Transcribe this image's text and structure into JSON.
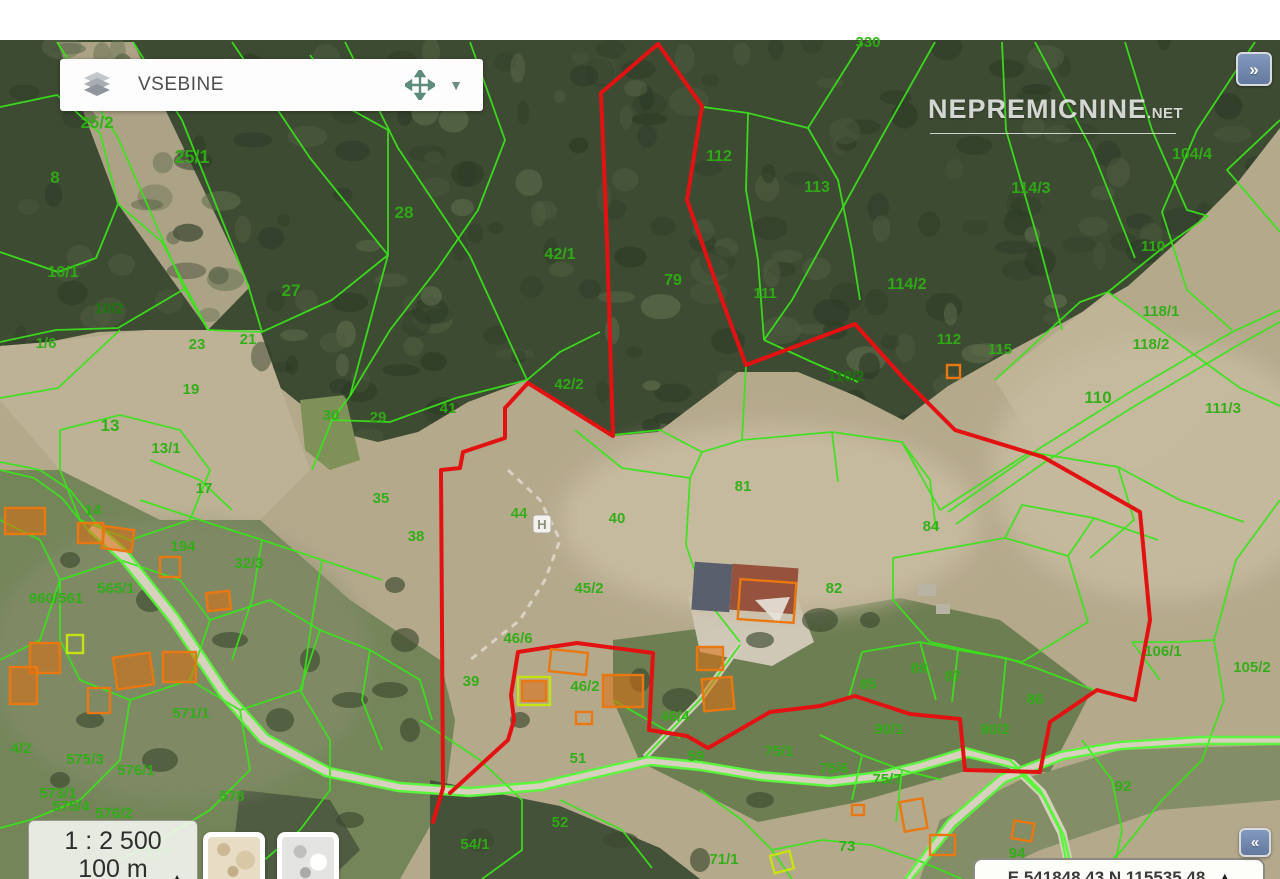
{
  "ui": {
    "contents_panel": {
      "label": "VSEBINE"
    },
    "dropdown_caret": "▼",
    "expand_button": {
      "glyph": "»"
    },
    "collapse_button": {
      "glyph": "«"
    },
    "watermark": {
      "brand": "NEPREMICNINE",
      "tld": ".NET"
    },
    "scale_panel": {
      "ratio": "1 : 2 500",
      "bar_label": "100 m",
      "toggle_glyph": "▲"
    },
    "coords_panel": {
      "text": "E 541848.43 N 115535.48",
      "toggle_glyph": "▲"
    }
  },
  "map": {
    "colors": {
      "parcel_line": "#3be31c",
      "road_line": "#57f73a",
      "selection": "#e31212",
      "building_outline": "#e8780f",
      "building_fill": "rgba(222,110,14,0.55)",
      "building_alt_outline": "#c6e212",
      "label_green": "#2fae15",
      "label_dark_green": "#1a7a0a"
    },
    "h_marker": {
      "glyph": "H",
      "x": 542,
      "y": 524
    },
    "labels": [
      {
        "t": "330",
        "x": 868,
        "y": 47
      },
      {
        "t": "25/2",
        "x": 97,
        "y": 128,
        "s": 17
      },
      {
        "t": "25/1",
        "x": 192,
        "y": 163,
        "s": 18
      },
      {
        "t": "8",
        "x": 55,
        "y": 183,
        "s": 17
      },
      {
        "t": "28",
        "x": 404,
        "y": 218,
        "s": 17
      },
      {
        "t": "27",
        "x": 291,
        "y": 296,
        "s": 17
      },
      {
        "t": "21",
        "x": 248,
        "y": 344
      },
      {
        "t": "23",
        "x": 197,
        "y": 349
      },
      {
        "t": "10/1",
        "x": 63,
        "y": 277,
        "s": 16
      },
      {
        "t": "10/2",
        "x": 109,
        "y": 313,
        "d": 1
      },
      {
        "t": "1/6",
        "x": 46,
        "y": 348
      },
      {
        "t": "19",
        "x": 191,
        "y": 394
      },
      {
        "t": "13",
        "x": 110,
        "y": 431,
        "s": 17
      },
      {
        "t": "13/1",
        "x": 166,
        "y": 453
      },
      {
        "t": "17",
        "x": 204,
        "y": 493
      },
      {
        "t": "30",
        "x": 331,
        "y": 420
      },
      {
        "t": "29",
        "x": 378,
        "y": 422
      },
      {
        "t": "41",
        "x": 448,
        "y": 413
      },
      {
        "t": "42/1",
        "x": 560,
        "y": 259,
        "s": 16
      },
      {
        "t": "42/2",
        "x": 569,
        "y": 389
      },
      {
        "t": "79",
        "x": 673,
        "y": 285,
        "s": 16
      },
      {
        "t": "112",
        "x": 719,
        "y": 161,
        "s": 16
      },
      {
        "t": "113",
        "x": 817,
        "y": 192,
        "s": 16
      },
      {
        "t": "114/3",
        "x": 1031,
        "y": 193,
        "s": 16
      },
      {
        "t": "104/4",
        "x": 1192,
        "y": 159,
        "s": 16
      },
      {
        "t": "114/2",
        "x": 907,
        "y": 289,
        "s": 16
      },
      {
        "t": "111",
        "x": 765,
        "y": 298
      },
      {
        "t": "110",
        "x": 1153,
        "y": 251
      },
      {
        "t": "118/1",
        "x": 1161,
        "y": 316
      },
      {
        "t": "118/2",
        "x": 1151,
        "y": 349
      },
      {
        "t": "115",
        "x": 1000,
        "y": 354
      },
      {
        "t": "112",
        "x": 949,
        "y": 344
      },
      {
        "t": "110/2",
        "x": 846,
        "y": 381,
        "d": 1
      },
      {
        "t": "111/3",
        "x": 1223,
        "y": 413
      },
      {
        "t": "110",
        "x": 1098,
        "y": 403,
        "s": 17
      },
      {
        "t": "35",
        "x": 381,
        "y": 503
      },
      {
        "t": "38",
        "x": 416,
        "y": 541
      },
      {
        "t": "44",
        "x": 519,
        "y": 518
      },
      {
        "t": "40",
        "x": 617,
        "y": 523
      },
      {
        "t": "45/2",
        "x": 589,
        "y": 593
      },
      {
        "t": "81",
        "x": 743,
        "y": 491
      },
      {
        "t": "84",
        "x": 931,
        "y": 531
      },
      {
        "t": "82",
        "x": 834,
        "y": 593
      },
      {
        "t": "14",
        "x": 93,
        "y": 515
      },
      {
        "t": "194",
        "x": 183,
        "y": 551
      },
      {
        "t": "32/3",
        "x": 249,
        "y": 568
      },
      {
        "t": "960/561",
        "x": 56,
        "y": 603
      },
      {
        "t": "565/1",
        "x": 116,
        "y": 593
      },
      {
        "t": "571/1",
        "x": 191,
        "y": 718
      },
      {
        "t": "575/3",
        "x": 85,
        "y": 764
      },
      {
        "t": "576/1",
        "x": 136,
        "y": 775
      },
      {
        "t": "573/1",
        "x": 58,
        "y": 798
      },
      {
        "t": "575/4",
        "x": 71,
        "y": 811
      },
      {
        "t": "576/2",
        "x": 114,
        "y": 818
      },
      {
        "t": "577",
        "x": 158,
        "y": 858
      },
      {
        "t": "578",
        "x": 232,
        "y": 801
      },
      {
        "t": "4/2",
        "x": 21,
        "y": 753
      },
      {
        "t": "54/1",
        "x": 475,
        "y": 849
      },
      {
        "t": "52",
        "x": 560,
        "y": 827
      },
      {
        "t": "51",
        "x": 578,
        "y": 763
      },
      {
        "t": "39",
        "x": 471,
        "y": 686
      },
      {
        "t": "46/6",
        "x": 518,
        "y": 643
      },
      {
        "t": "46/2",
        "x": 585,
        "y": 691
      },
      {
        "t": "46/4",
        "x": 675,
        "y": 721
      },
      {
        "t": "59",
        "x": 696,
        "y": 761
      },
      {
        "t": "75/1",
        "x": 779,
        "y": 756
      },
      {
        "t": "75/6",
        "x": 834,
        "y": 773
      },
      {
        "t": "75/7",
        "x": 887,
        "y": 784
      },
      {
        "t": "73",
        "x": 847,
        "y": 851
      },
      {
        "t": "71/1",
        "x": 724,
        "y": 864
      },
      {
        "t": "88",
        "x": 919,
        "y": 673
      },
      {
        "t": "87",
        "x": 953,
        "y": 681
      },
      {
        "t": "85",
        "x": 868,
        "y": 689
      },
      {
        "t": "86",
        "x": 1035,
        "y": 704
      },
      {
        "t": "90/1",
        "x": 889,
        "y": 734
      },
      {
        "t": "90/2",
        "x": 995,
        "y": 734
      },
      {
        "t": "106/1",
        "x": 1163,
        "y": 656
      },
      {
        "t": "105/2",
        "x": 1252,
        "y": 672
      },
      {
        "t": "92",
        "x": 1123,
        "y": 791
      },
      {
        "t": "94",
        "x": 1017,
        "y": 858
      }
    ]
  }
}
